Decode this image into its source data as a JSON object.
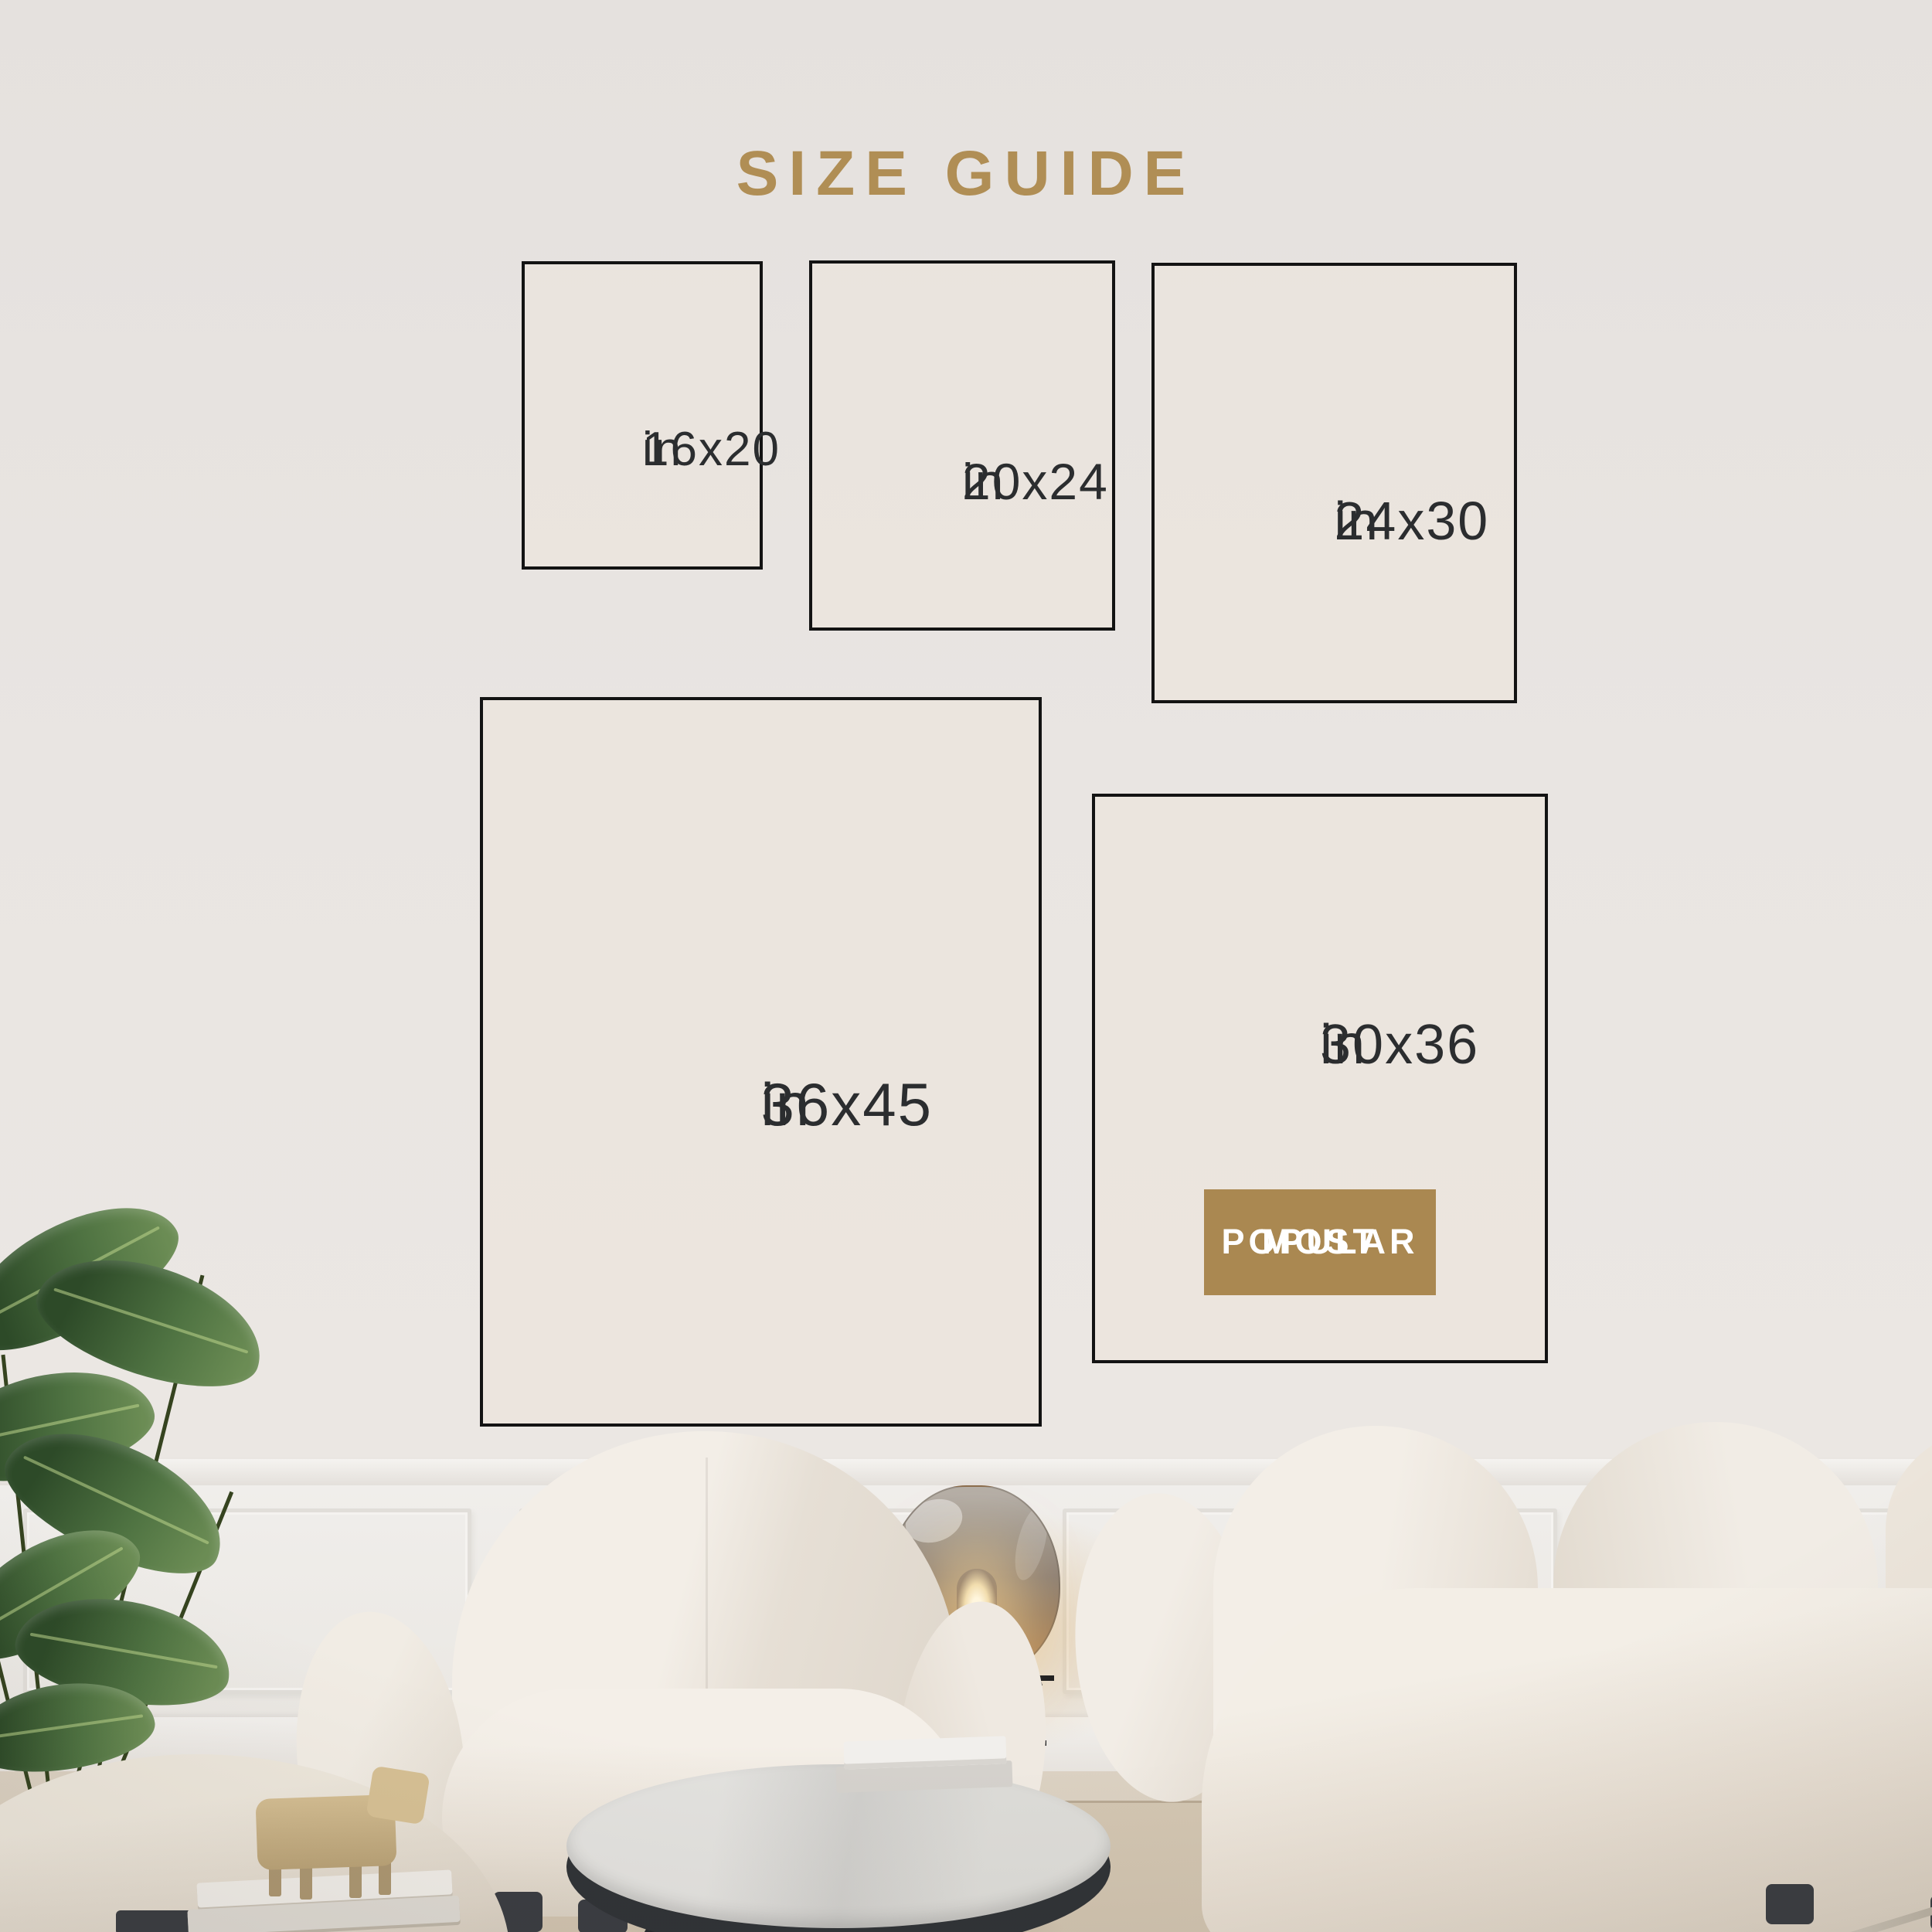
{
  "title": "SIZE GUIDE",
  "sizes": [
    {
      "label": "16x20",
      "unit": "in"
    },
    {
      "label": "20x24",
      "unit": "in"
    },
    {
      "label": "24x30",
      "unit": "in"
    },
    {
      "label": "36x45",
      "unit": "in"
    },
    {
      "label": "30x36",
      "unit": "in"
    }
  ],
  "most_popular": {
    "line1": "MOST",
    "line2": "POPULAR"
  },
  "colors": {
    "accent_gold": "#b08e55",
    "badge_gold": "#aa8851",
    "badge_text": "#ffffff",
    "size_text": "#2b2d2f",
    "box_border": "#131313",
    "wall_top": "#e5e1de",
    "wall_bottom": "#ebe7e3",
    "wainscot": "#efedea",
    "floor": "#d6cbba",
    "rug": "#cfc2ae",
    "sofa": "#f1ece5",
    "leg_dark": "#3a3d42",
    "lamp_amber": "#ae8558",
    "plant_green": "#41603a",
    "table_top": "#d9d8d5"
  },
  "scene": {
    "items": [
      "potted banana-leaf plant",
      "cream boucle ottoman",
      "cream boucle armchair",
      "smoked amber glass floor lamp on black metal stand",
      "round marble coffee table with stacked books",
      "wooden toy animal on stacked books",
      "cream boucle sofa",
      "white wainscoting wall",
      "beige rug"
    ]
  }
}
